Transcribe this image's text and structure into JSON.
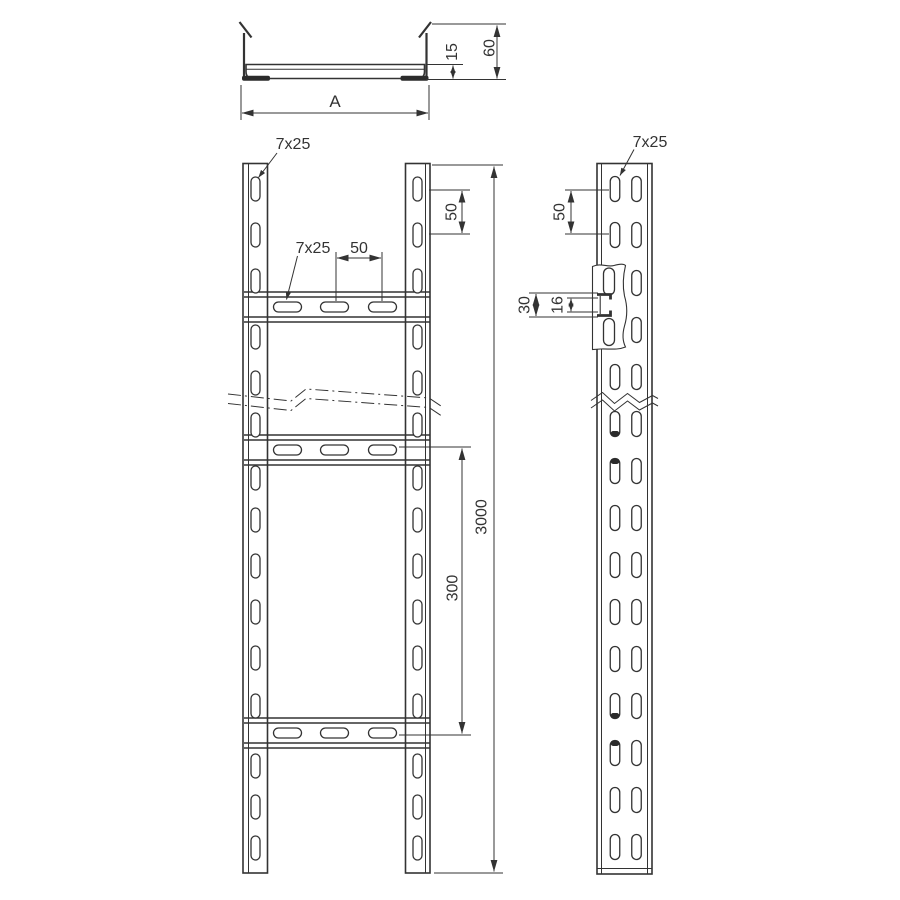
{
  "page": {
    "background": "#ffffff",
    "line_color": "#333333",
    "description": "cable-ladder-technical-drawing"
  },
  "cross_section_view": {
    "dim_rung_height": "15",
    "dim_total_height": "60",
    "dim_width": "A"
  },
  "front_view": {
    "label_rail_slot": "7x25",
    "label_rung_slot": "7x25",
    "dim_rung_slot_pitch": "50",
    "dim_rail_slot_pitch": "50",
    "dim_rung_spacing": "300",
    "dim_total_length": "3000"
  },
  "side_view": {
    "label_slot": "7x25",
    "dim_slot_pitch": "50",
    "dim_clamp_outer": "30",
    "dim_clamp_inner": "16"
  }
}
